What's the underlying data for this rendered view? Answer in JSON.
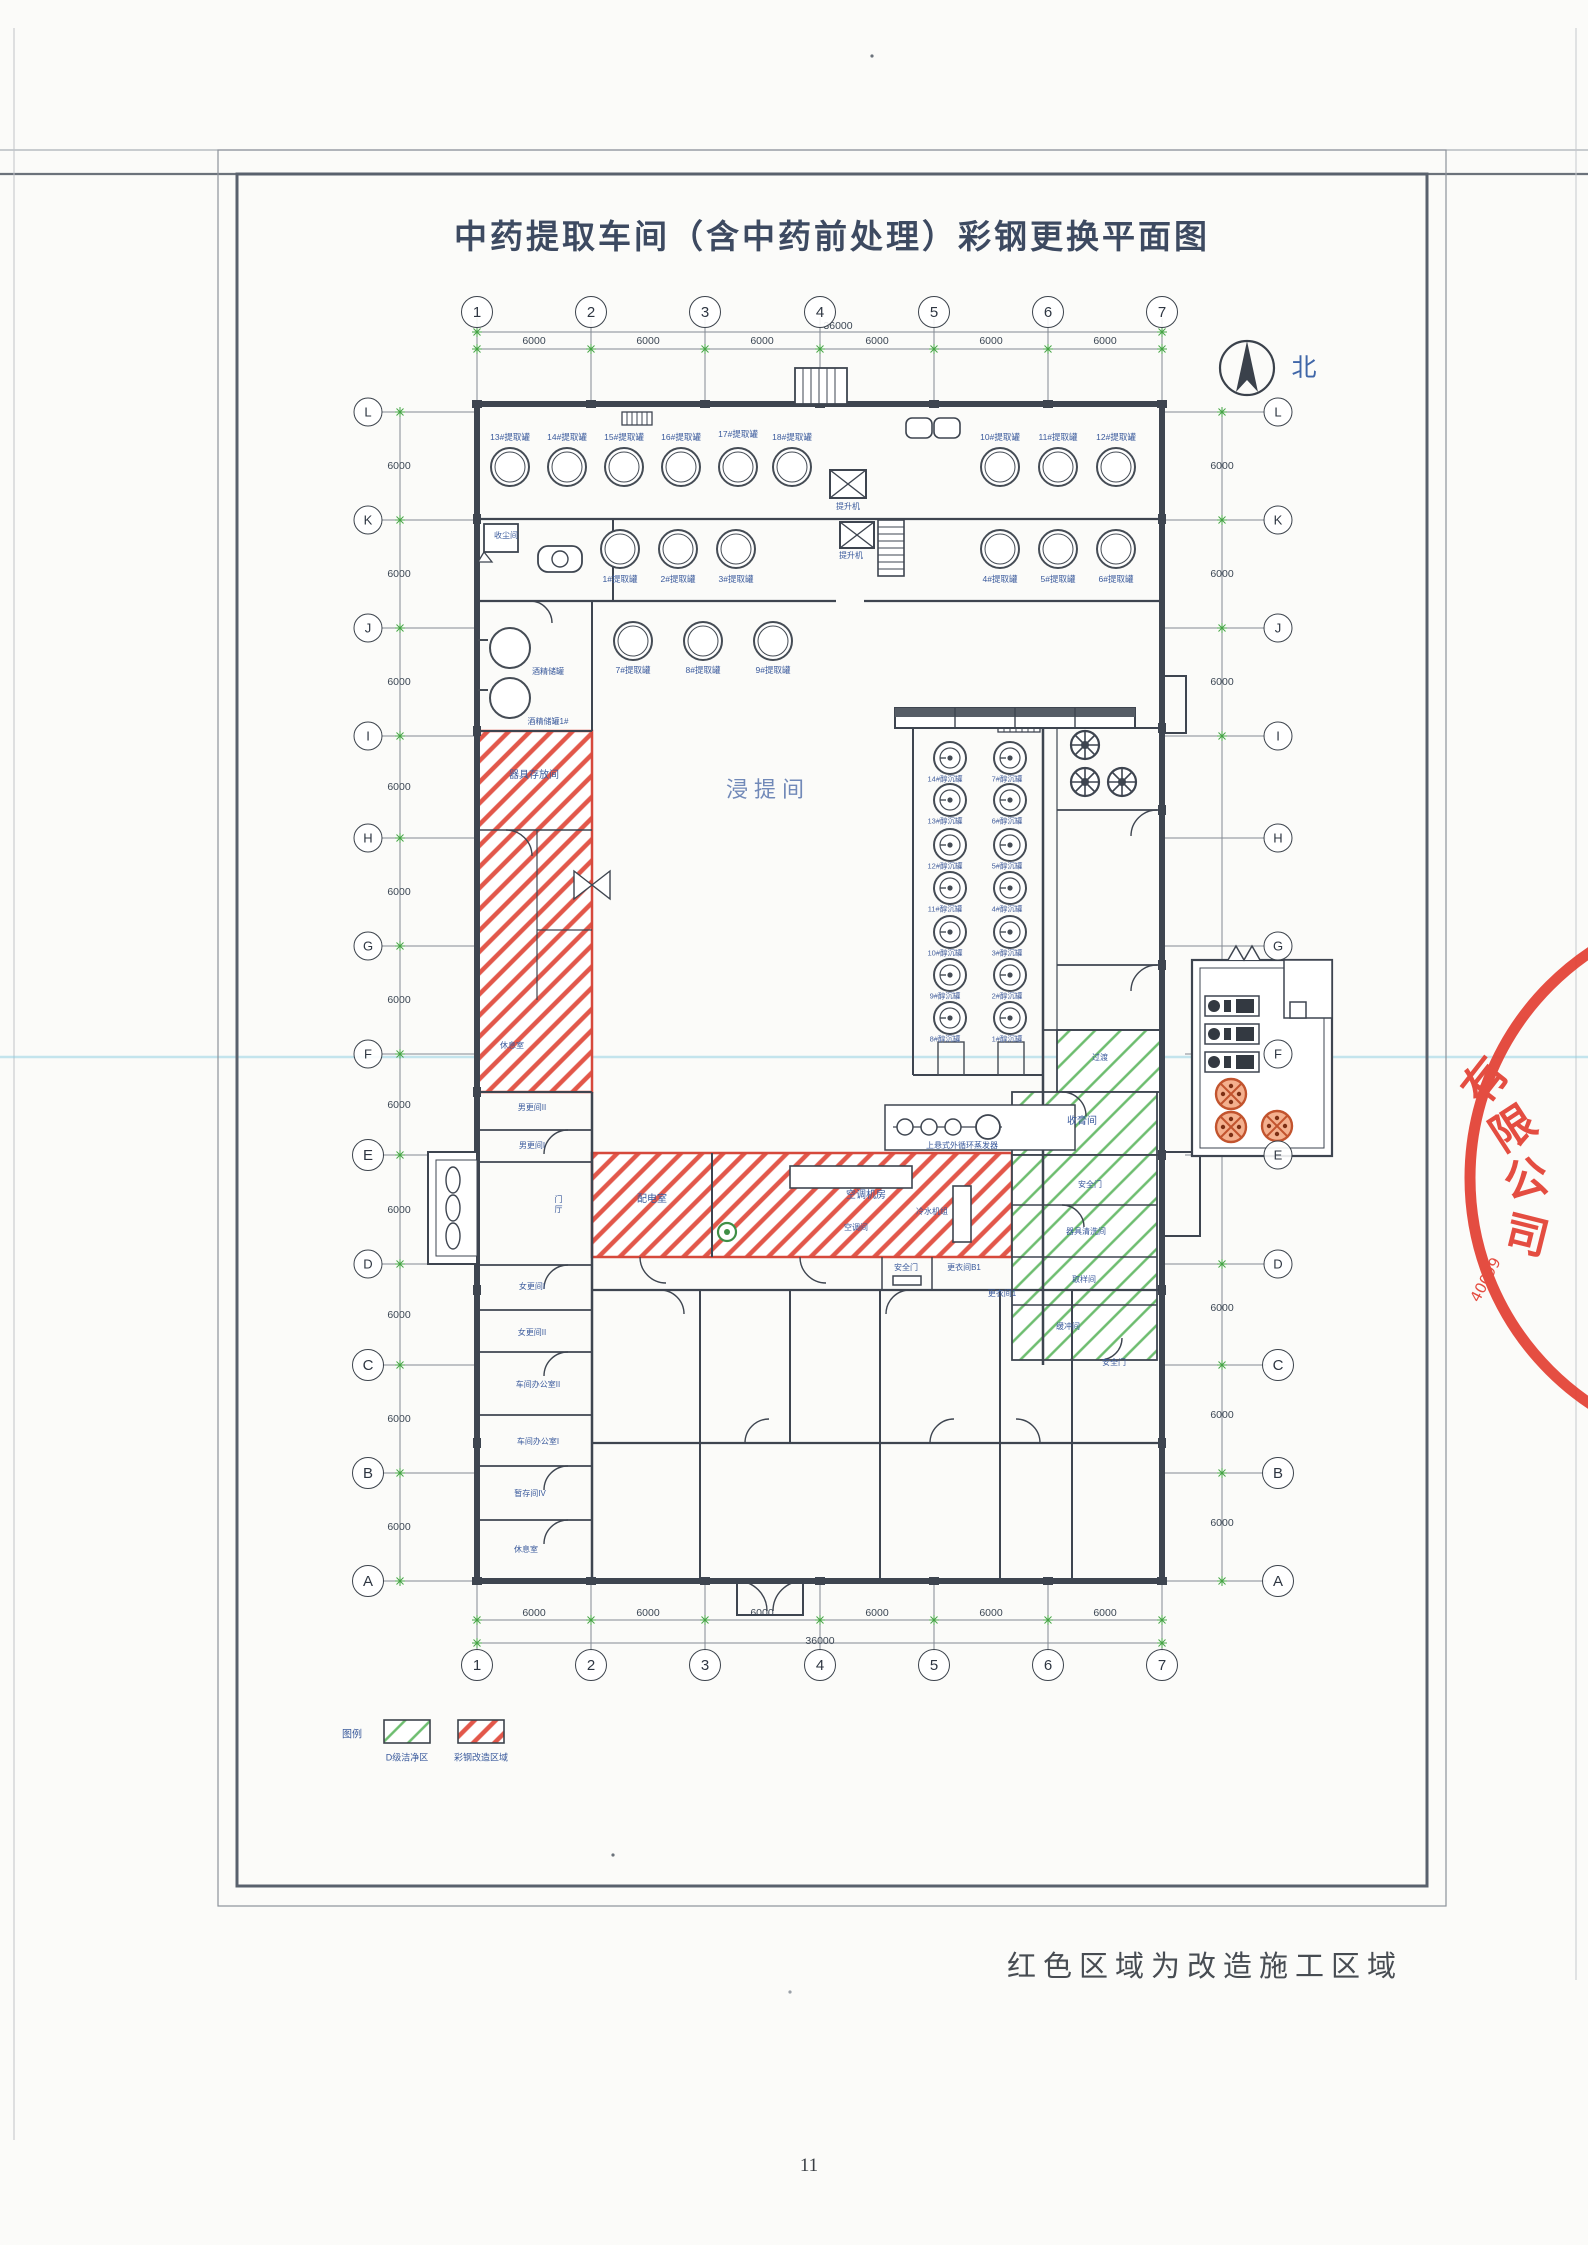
{
  "page": {
    "title": "中药提取车间（含中药前处理）彩钢更换平面图",
    "note": "红色区域为改造施工区域",
    "page_number": "11",
    "north_label": "北"
  },
  "legend": {
    "heading": "图例",
    "clean_area": "D级洁净区",
    "renovation_area": "彩钢改造区域"
  },
  "grid": {
    "cols": [
      "1",
      "2",
      "3",
      "4",
      "5",
      "6",
      "7"
    ],
    "rows": [
      "L",
      "K",
      "J",
      "I",
      "H",
      "G",
      "F",
      "E",
      "D",
      "C",
      "B",
      "A"
    ],
    "bay_dim": "6000",
    "total_dim": "36000"
  },
  "rooms": {
    "extraction_hall": "浸提间",
    "tool_storage": "器具存放间",
    "dust_collection": "收尘间",
    "rest_room": "休息室",
    "male_change_2": "男更间II",
    "male_change_1": "男更间I",
    "entrance_hall": "门厅",
    "female_change_1": "女更间I",
    "female_change_2": "女更间II",
    "office_2": "车间办公室II",
    "office_1": "车间办公室I",
    "temp_storage_4": "暂存间IV",
    "power_room": "配电室",
    "ahu_room": "空调机房",
    "ac_room": "空调间",
    "chiller_unit": "冷水机组",
    "transition": "过渡",
    "paste_room": "收膏间",
    "tool_wash": "器具清洗间",
    "sampling_room": "取样间",
    "buffer_room": "缓冲间",
    "safety_door": "安全门",
    "change_b1": "更衣间B1",
    "change_1": "更衣间1"
  },
  "equipment": {
    "hoist": "提升机",
    "evaporator": "上悬式外循环蒸发器",
    "alcohol_tank": "酒精储罐",
    "alcohol_tank_1": "酒精储罐1#"
  },
  "tanks": {
    "row1": [
      "13#提取罐",
      "14#提取罐",
      "15#提取罐",
      "16#提取罐",
      "17#提取罐",
      "18#提取罐",
      "10#提取罐",
      "11#提取罐",
      "12#提取罐"
    ],
    "row2": [
      "1#提取罐",
      "2#提取罐",
      "3#提取罐",
      "4#提取罐",
      "5#提取罐",
      "6#提取罐"
    ],
    "row3": [
      "7#提取罐",
      "8#提取罐",
      "9#提取罐"
    ],
    "cc_left": [
      "14#醇沉罐",
      "13#醇沉罐",
      "12#醇沉罐",
      "11#醇沉罐",
      "10#醇沉罐",
      "9#醇沉罐",
      "8#醇沉罐"
    ],
    "cc_right": [
      "7#醇沉罐",
      "6#醇沉罐",
      "5#醇沉罐",
      "4#醇沉罐",
      "3#醇沉罐",
      "2#醇沉罐",
      "1#醇沉罐"
    ]
  },
  "stamp": {
    "chars": [
      "有",
      "限",
      "公",
      "司"
    ],
    "digits": "40099",
    "color": "#e23b2e"
  },
  "colors": {
    "renovation_red": "#d6493c",
    "clean_green": "#49a84c",
    "line_dark": "#3e4550",
    "label_blue": "#3a5a9c"
  }
}
